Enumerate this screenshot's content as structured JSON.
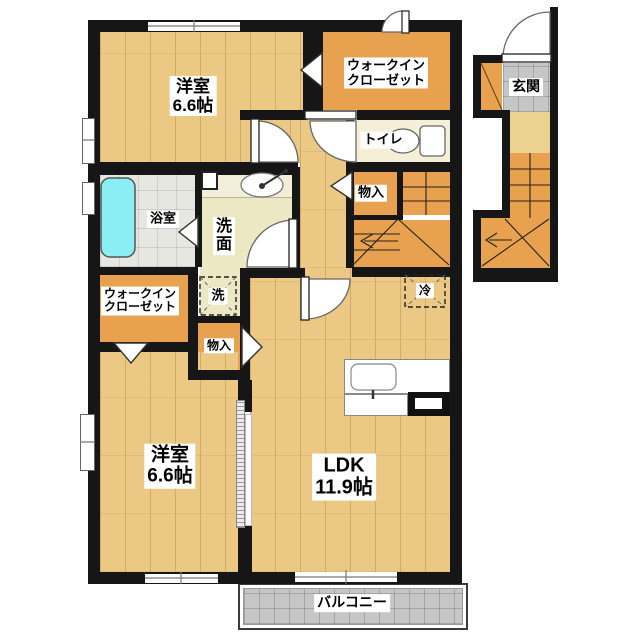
{
  "rooms": {
    "bedroom_top": {
      "name": "洋室",
      "size": "6.6帖"
    },
    "walkin_closet_top": {
      "line1": "ウォークイン",
      "line2": "クローゼット"
    },
    "entrance": {
      "label": "玄関"
    },
    "toilet": {
      "label": "トイレ"
    },
    "storage_upper": {
      "label": "物入"
    },
    "bathroom": {
      "label": "浴室"
    },
    "washroom": {
      "line1": "洗",
      "line2": "面"
    },
    "laundry": {
      "label": "洗"
    },
    "walkin_closet_lower": {
      "line1": "ウォークイン",
      "line2": "クローゼット"
    },
    "storage_lower": {
      "label": "物入"
    },
    "bedroom_lower": {
      "name": "洋室",
      "size": "6.6帖"
    },
    "ldk": {
      "name": "LDK",
      "size": "11.9帖"
    },
    "refrigerator": {
      "label": "冷"
    },
    "balcony": {
      "label": "バルコニー"
    }
  },
  "colors": {
    "wall": "#161616",
    "wood_floor": "#ebc985",
    "closet_orange": "#e8a14e",
    "bathtub_cyan": "#8beef2",
    "tile_gray": "#c6c6c6",
    "toilet_floor": "#f4efd6",
    "washroom_floor": "#ece8c4",
    "stair_landing": "#ecd28f"
  }
}
